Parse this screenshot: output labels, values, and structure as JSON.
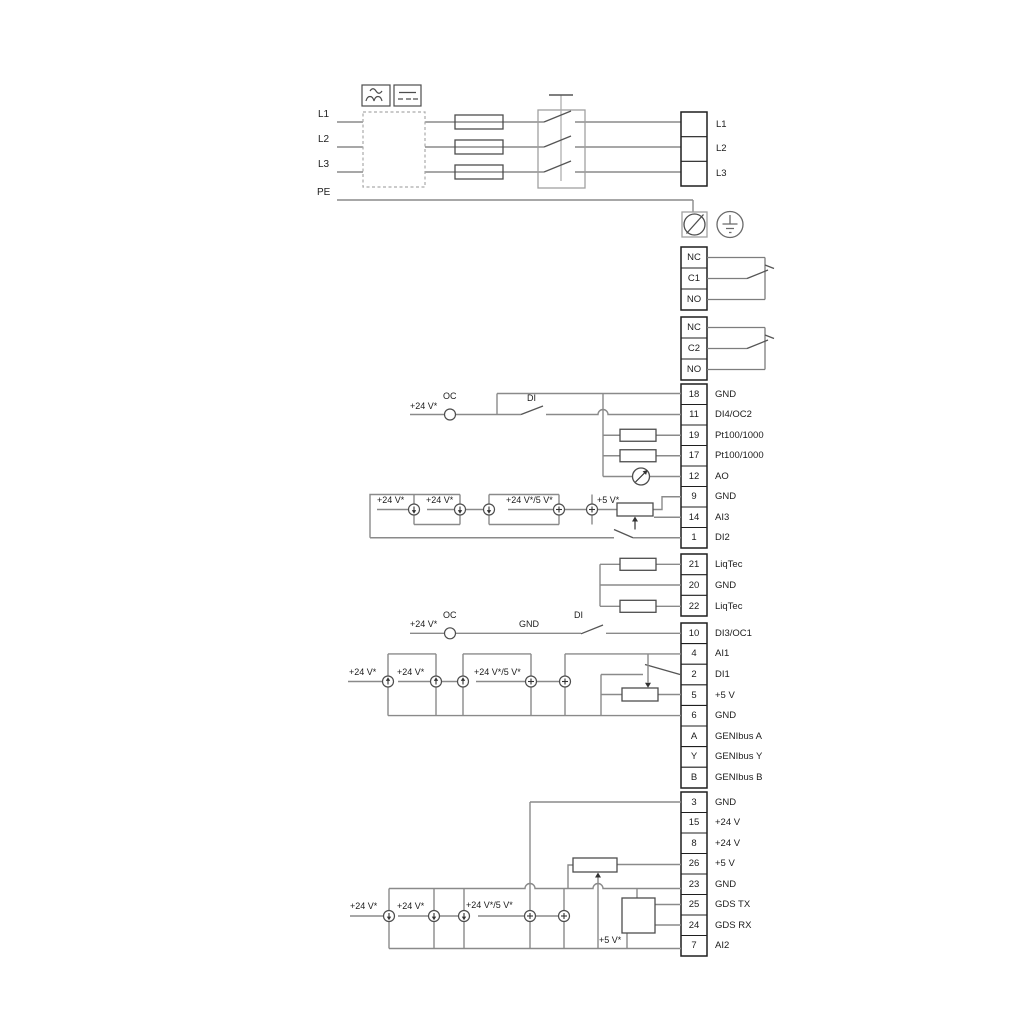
{
  "power": {
    "inputs": [
      "L1",
      "L2",
      "L3",
      "PE"
    ],
    "outputs": [
      "L1",
      "L2",
      "L3"
    ]
  },
  "relay1": [
    "NC",
    "C1",
    "NO"
  ],
  "relay2": [
    "NC",
    "C2",
    "NO"
  ],
  "io1": [
    {
      "num": "18",
      "label": "GND"
    },
    {
      "num": "11",
      "label": "DI4/OC2"
    },
    {
      "num": "19",
      "label": "Pt100/1000"
    },
    {
      "num": "17",
      "label": "Pt100/1000"
    },
    {
      "num": "12",
      "label": "AO"
    },
    {
      "num": "9",
      "label": "GND"
    },
    {
      "num": "14",
      "label": "AI3"
    },
    {
      "num": "1",
      "label": "DI2"
    }
  ],
  "liqtec": [
    {
      "num": "21",
      "label": "LiqTec"
    },
    {
      "num": "20",
      "label": "GND"
    },
    {
      "num": "22",
      "label": "LiqTec"
    }
  ],
  "io2": [
    {
      "num": "10",
      "label": "DI3/OC1"
    },
    {
      "num": "4",
      "label": "AI1"
    },
    {
      "num": "2",
      "label": "DI1"
    },
    {
      "num": "5",
      "label": "+5 V"
    },
    {
      "num": "6",
      "label": "GND"
    },
    {
      "num": "A",
      "label": "GENIbus A"
    },
    {
      "num": "Y",
      "label": "GENIbus Y"
    },
    {
      "num": "B",
      "label": "GENIbus B"
    }
  ],
  "io3": [
    {
      "num": "3",
      "label": "GND"
    },
    {
      "num": "15",
      "label": "+24 V"
    },
    {
      "num": "8",
      "label": "+24 V"
    },
    {
      "num": "26",
      "label": "+5 V"
    },
    {
      "num": "23",
      "label": "GND"
    },
    {
      "num": "25",
      "label": "GDS TX"
    },
    {
      "num": "24",
      "label": "GDS RX"
    },
    {
      "num": "7",
      "label": "AI2"
    }
  ],
  "ann": {
    "p24": "+24 V*",
    "p245": "+24 V*/5 V*",
    "p5": "+5 V*",
    "oc": "OC",
    "di": "DI",
    "gnd": "GND"
  },
  "colors": {
    "wire": "#8a8a8a",
    "component": "#4d4d4d",
    "block": "#1f1f1f"
  }
}
